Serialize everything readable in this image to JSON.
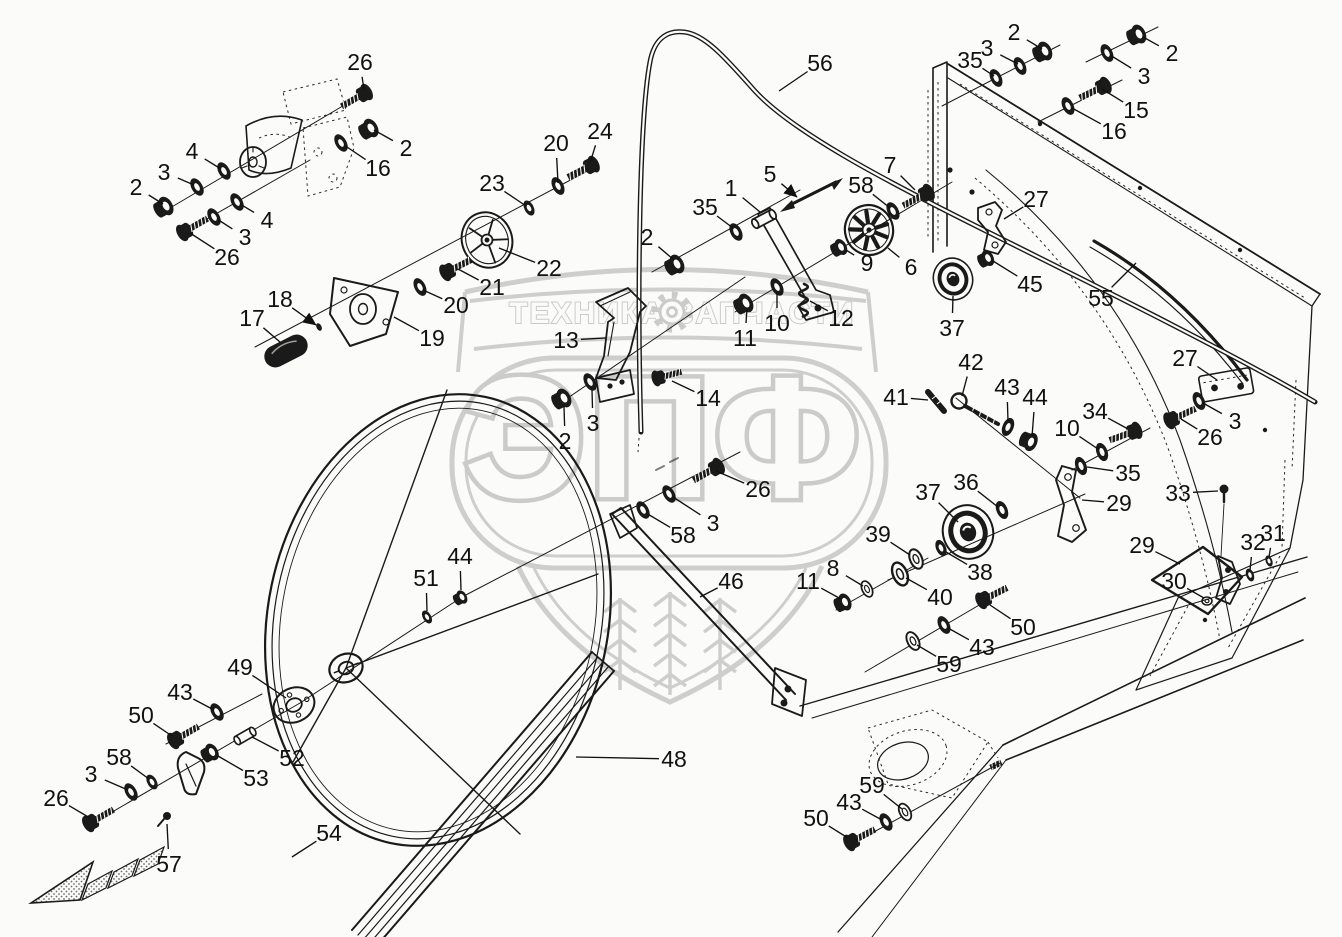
{
  "page": {
    "type": "exploded-parts-diagram",
    "colors": {
      "paper": "#fbfbf9",
      "ink": "#1a1a1a",
      "watermark": "#c7c7c7"
    }
  },
  "watermark": {
    "brand_left": "ТЕХНИКА",
    "brand_right": "ЗАПЧАСТИ",
    "brand_big": "ЭПФ",
    "gear_icon": "gear",
    "shield_icon": "shield-with-wheat"
  },
  "callouts": [
    {
      "t": "26",
      "x": 360,
      "y": 62,
      "tx": 364,
      "ty": 90
    },
    {
      "t": "2",
      "x": 406,
      "y": 148,
      "tx": 374,
      "ty": 130
    },
    {
      "t": "16",
      "x": 378,
      "y": 168,
      "tx": 344,
      "ty": 145
    },
    {
      "t": "4",
      "x": 192,
      "y": 151,
      "tx": 221,
      "ty": 169
    },
    {
      "t": "3",
      "x": 164,
      "y": 172,
      "tx": 194,
      "ty": 185
    },
    {
      "t": "2",
      "x": 136,
      "y": 187,
      "tx": 163,
      "ty": 204
    },
    {
      "t": "4",
      "x": 267,
      "y": 220,
      "tx": 240,
      "ty": 204
    },
    {
      "t": "3",
      "x": 245,
      "y": 237,
      "tx": 217,
      "ty": 219
    },
    {
      "t": "26",
      "x": 227,
      "y": 257,
      "tx": 190,
      "ty": 233
    },
    {
      "t": "17",
      "x": 252,
      "y": 318,
      "tx": 280,
      "ty": 342
    },
    {
      "t": "18",
      "x": 280,
      "y": 299,
      "tx": 316,
      "ty": 325,
      "a": 1
    },
    {
      "t": "19",
      "x": 432,
      "y": 338,
      "tx": 394,
      "ty": 317
    },
    {
      "t": "20",
      "x": 456,
      "y": 305,
      "tx": 423,
      "ty": 290
    },
    {
      "t": "21",
      "x": 492,
      "y": 287,
      "tx": 458,
      "ty": 269
    },
    {
      "t": "22",
      "x": 549,
      "y": 268,
      "tx": 499,
      "ty": 248
    },
    {
      "t": "23",
      "x": 492,
      "y": 183,
      "tx": 526,
      "ty": 206
    },
    {
      "t": "20",
      "x": 556,
      "y": 143,
      "tx": 558,
      "ty": 183
    },
    {
      "t": "24",
      "x": 600,
      "y": 131,
      "tx": 590,
      "ty": 163
    },
    {
      "t": "56",
      "x": 820,
      "y": 63,
      "tx": 779,
      "ty": 91
    },
    {
      "t": "13",
      "x": 566,
      "y": 340,
      "tx": 606,
      "ty": 338
    },
    {
      "t": "14",
      "x": 708,
      "y": 398,
      "tx": 672,
      "ty": 381
    },
    {
      "t": "3",
      "x": 593,
      "y": 423,
      "tx": 592,
      "ty": 390
    },
    {
      "t": "2",
      "x": 565,
      "y": 441,
      "tx": 564,
      "ty": 406
    },
    {
      "t": "2",
      "x": 647,
      "y": 237,
      "tx": 674,
      "ty": 260
    },
    {
      "t": "35",
      "x": 705,
      "y": 207,
      "tx": 733,
      "ty": 228
    },
    {
      "t": "1",
      "x": 731,
      "y": 188,
      "tx": 760,
      "ty": 212
    },
    {
      "t": "5",
      "x": 770,
      "y": 174,
      "tx": 797,
      "ty": 197,
      "a": 1
    },
    {
      "t": "58",
      "x": 861,
      "y": 185,
      "tx": 890,
      "ty": 208
    },
    {
      "t": "7",
      "x": 890,
      "y": 165,
      "tx": 915,
      "ty": 190
    },
    {
      "t": "9",
      "x": 867,
      "y": 263,
      "tx": 846,
      "ty": 250
    },
    {
      "t": "6",
      "x": 911,
      "y": 267,
      "tx": 888,
      "ty": 248
    },
    {
      "t": "12",
      "x": 841,
      "y": 318,
      "tx": 810,
      "ty": 301
    },
    {
      "t": "10",
      "x": 777,
      "y": 323,
      "tx": 777,
      "ty": 292
    },
    {
      "t": "11",
      "x": 745,
      "y": 338,
      "tx": 747,
      "ty": 308
    },
    {
      "t": "26",
      "x": 758,
      "y": 489,
      "tx": 716,
      "ty": 471
    },
    {
      "t": "3",
      "x": 713,
      "y": 523,
      "tx": 673,
      "ty": 497
    },
    {
      "t": "58",
      "x": 683,
      "y": 535,
      "tx": 646,
      "ty": 513
    },
    {
      "t": "35",
      "x": 970,
      "y": 60,
      "tx": 994,
      "ty": 76
    },
    {
      "t": "3",
      "x": 987,
      "y": 48,
      "tx": 1018,
      "ty": 64
    },
    {
      "t": "2",
      "x": 1014,
      "y": 32,
      "tx": 1042,
      "ty": 49
    },
    {
      "t": "2",
      "x": 1172,
      "y": 53,
      "tx": 1143,
      "ty": 37
    },
    {
      "t": "3",
      "x": 1144,
      "y": 76,
      "tx": 1110,
      "ty": 55
    },
    {
      "t": "15",
      "x": 1136,
      "y": 110,
      "tx": 1102,
      "ty": 89
    },
    {
      "t": "16",
      "x": 1114,
      "y": 131,
      "tx": 1072,
      "ty": 108
    },
    {
      "t": "27",
      "x": 1036,
      "y": 199,
      "tx": 1004,
      "ty": 219
    },
    {
      "t": "45",
      "x": 1030,
      "y": 284,
      "tx": 993,
      "ty": 261
    },
    {
      "t": "37",
      "x": 952,
      "y": 328,
      "tx": 953,
      "ty": 296
    },
    {
      "t": "55",
      "x": 1101,
      "y": 298,
      "tx": 1136,
      "ty": 263
    },
    {
      "t": "41",
      "x": 896,
      "y": 397,
      "tx": 928,
      "ty": 400
    },
    {
      "t": "42",
      "x": 971,
      "y": 362,
      "tx": 962,
      "ty": 396
    },
    {
      "t": "43",
      "x": 1007,
      "y": 387,
      "tx": 1008,
      "ty": 421
    },
    {
      "t": "44",
      "x": 1035,
      "y": 397,
      "tx": 1032,
      "ty": 437
    },
    {
      "t": "34",
      "x": 1095,
      "y": 411,
      "tx": 1128,
      "ty": 429
    },
    {
      "t": "10",
      "x": 1067,
      "y": 428,
      "tx": 1098,
      "ty": 449
    },
    {
      "t": "35",
      "x": 1128,
      "y": 473,
      "tx": 1087,
      "ty": 467
    },
    {
      "t": "36",
      "x": 966,
      "y": 482,
      "tx": 998,
      "ty": 507
    },
    {
      "t": "37",
      "x": 928,
      "y": 492,
      "tx": 958,
      "ty": 522
    },
    {
      "t": "29",
      "x": 1119,
      "y": 503,
      "tx": 1082,
      "ty": 500
    },
    {
      "t": "27",
      "x": 1185,
      "y": 358,
      "tx": 1217,
      "ty": 380
    },
    {
      "t": "3",
      "x": 1235,
      "y": 421,
      "tx": 1203,
      "ty": 403
    },
    {
      "t": "26",
      "x": 1210,
      "y": 437,
      "tx": 1181,
      "ty": 419
    },
    {
      "t": "33",
      "x": 1178,
      "y": 493,
      "tx": 1218,
      "ty": 491
    },
    {
      "t": "29",
      "x": 1142,
      "y": 545,
      "tx": 1180,
      "ty": 564
    },
    {
      "t": "30",
      "x": 1174,
      "y": 581,
      "tx": 1204,
      "ty": 598
    },
    {
      "t": "32",
      "x": 1253,
      "y": 542,
      "tx": 1250,
      "ty": 570
    },
    {
      "t": "31",
      "x": 1273,
      "y": 533,
      "tx": 1269,
      "ty": 557
    },
    {
      "t": "39",
      "x": 878,
      "y": 534,
      "tx": 910,
      "ty": 555
    },
    {
      "t": "38",
      "x": 980,
      "y": 572,
      "tx": 946,
      "ty": 552
    },
    {
      "t": "40",
      "x": 940,
      "y": 597,
      "tx": 906,
      "ty": 578
    },
    {
      "t": "50",
      "x": 1023,
      "y": 627,
      "tx": 990,
      "ty": 605
    },
    {
      "t": "43",
      "x": 982,
      "y": 647,
      "tx": 948,
      "ty": 628
    },
    {
      "t": "59",
      "x": 949,
      "y": 664,
      "tx": 917,
      "ty": 645
    },
    {
      "t": "8",
      "x": 833,
      "y": 568,
      "tx": 863,
      "ty": 586
    },
    {
      "t": "11",
      "x": 808,
      "y": 581,
      "tx": 841,
      "ty": 599
    },
    {
      "t": "46",
      "x": 731,
      "y": 581,
      "tx": 700,
      "ty": 597
    },
    {
      "t": "48",
      "x": 674,
      "y": 759,
      "tx": 576,
      "ty": 757
    },
    {
      "t": "51",
      "x": 426,
      "y": 578,
      "tx": 427,
      "ty": 611
    },
    {
      "t": "44",
      "x": 460,
      "y": 556,
      "tx": 461,
      "ty": 590
    },
    {
      "t": "49",
      "x": 240,
      "y": 667,
      "tx": 286,
      "ty": 698
    },
    {
      "t": "43",
      "x": 180,
      "y": 692,
      "tx": 214,
      "ty": 710
    },
    {
      "t": "50",
      "x": 141,
      "y": 715,
      "tx": 172,
      "ty": 736
    },
    {
      "t": "52",
      "x": 292,
      "y": 758,
      "tx": 252,
      "ty": 737
    },
    {
      "t": "53",
      "x": 256,
      "y": 778,
      "tx": 218,
      "ty": 756
    },
    {
      "t": "58",
      "x": 119,
      "y": 757,
      "tx": 149,
      "ty": 779
    },
    {
      "t": "3",
      "x": 91,
      "y": 774,
      "tx": 128,
      "ty": 790
    },
    {
      "t": "26",
      "x": 56,
      "y": 798,
      "tx": 90,
      "ty": 818
    },
    {
      "t": "57",
      "x": 169,
      "y": 864,
      "tx": 167,
      "ty": 824
    },
    {
      "t": "54",
      "x": 329,
      "y": 833,
      "tx": 292,
      "ty": 857
    },
    {
      "t": "59",
      "x": 872,
      "y": 785,
      "tx": 902,
      "ty": 809
    },
    {
      "t": "43",
      "x": 849,
      "y": 802,
      "tx": 882,
      "ty": 820
    },
    {
      "t": "50",
      "x": 816,
      "y": 818,
      "tx": 848,
      "ty": 838
    }
  ]
}
